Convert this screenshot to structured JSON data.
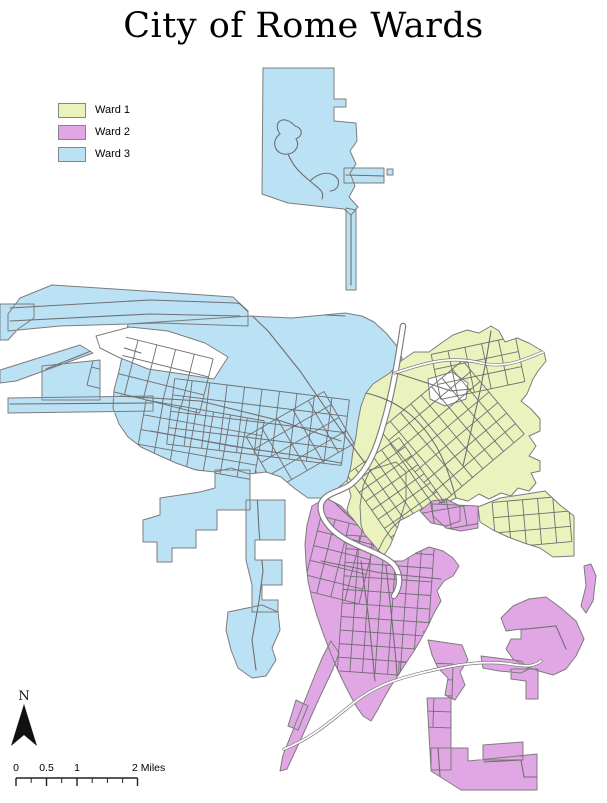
{
  "title": "City of Rome Wards",
  "legend": {
    "items": [
      {
        "label": "Ward 1",
        "color": "#EAF3BD"
      },
      {
        "label": "Ward 2",
        "color": "#E1A7E5"
      },
      {
        "label": "Ward 3",
        "color": "#BBE1F5"
      }
    ]
  },
  "north_arrow": {
    "label": "N",
    "points": "24,704 37,746 24,735 11,746",
    "label_x": 24,
    "label_y": 700,
    "color": "#111111"
  },
  "scale_bar": {
    "unit_labels": [
      "0",
      "0.5",
      "1",
      "2 Miles"
    ],
    "bar_y": 778,
    "x_start": 16,
    "x_end": 137.5,
    "major_ticks": [
      16,
      46.5,
      77,
      137.5
    ],
    "minor_ticks": [
      31.2,
      61.7,
      92.2,
      107.4,
      122.6
    ],
    "labels": [
      {
        "text": "0",
        "x": 16,
        "anchor": "middle"
      },
      {
        "text": "0.5",
        "x": 46.5,
        "anchor": "middle"
      },
      {
        "text": "1",
        "x": 77,
        "anchor": "middle"
      },
      {
        "text": "2 Miles",
        "x": 132,
        "anchor": "start"
      }
    ],
    "color": "#222222"
  },
  "map": {
    "background": "#FFFFFF",
    "boundary_color": "#7C7C7C",
    "road_color": "#6F6F6F",
    "river_casing": "#7D7D7D",
    "wards": [
      {
        "id": "w3",
        "name": "Ward 3",
        "color": "#BBE1F5",
        "path": "M263,68 L334,68 L334,99 L346,99 L346,107 L334,107 L334,121 L356,123 L357,141 L350,151 L356,164 L350,173 L355,186 L349,197 L358,207 L351,215 L344,209 L316,206 L288,203 L262,194 Z M344,168 L384,168 L384,183 L344,183 Z M387,169 L393,169 L393,175 L387,175 Z M346,208 L356,210 L356,290 L346,290 Z M8,314 L20,298 L52,285 L160,292 L233,297 L248,311 L248,326 L160,323 L60,326 L8,331 Z M0,304 L34,304 L34,318 L18,329 L8,340 L0,340 Z M0,370 L80,345 L93,353 L16,381 L0,383 Z M8,398 L153,396 L153,411 L8,413 Z M42,366 L100,360 L100,400 L42,400 Z M128,324 L250,316 L292,318 L345,313 L362,316 L374,322 L386,333 L396,345 L402,358 L401,375 L394,398 L385,420 L375,444 L363,464 L351,477 L338,488 L330,498 L308,498 L294,488 L281,477 L266,472 L249,474 L231,468 L215,472 L196,470 L176,463 L158,455 L141,447 L128,437 L119,424 L113,408 L114,390 L119,371 L124,348 Z M215,470 L250,470 L250,510 L217,510 L217,530 L196,530 L196,548 L172,548 L172,562 L157,562 L157,542 L143,542 L143,520 L160,515 L160,498 L180,495 L200,492 L215,488 Z M246,500 L285,500 L285,540 L255,540 L255,560 L282,560 L282,585 L262,585 L262,600 L278,600 L278,612 L252,612 L252,585 L246,560 Z M228,612 L262,605 L278,612 L280,630 L272,648 L276,660 L266,676 L252,678 L238,668 L231,650 L226,630 Z"
      },
      {
        "id": "w1",
        "name": "Ward 1",
        "color": "#EAF3BD",
        "path": "M390,373 L401,361 L414,352 L429,352 L440,344 L453,335 L467,330 L479,333 L491,326 L499,331 L505,342 L517,338 L529,343 L544,352 L546,361 L538,371 L533,379 L527,394 L521,401 L531,409 L540,419 L540,431 L529,436 L536,446 L529,456 L540,461 L540,471 L531,473 L536,483 L529,491 L518,488 L511,496 L501,493 L489,499 L479,494 L468,501 L456,498 L444,504 L433,504 L421,509 L409,516 L399,521 L391,529 L384,539 L379,549 L373,554 L364,546 L357,536 L351,523 L347,509 L351,496 L347,481 L351,466 L353,451 L356,436 L358,421 L361,406 L366,393 L373,384 L382,378 Z M478,507 L500,498 L520,495 L545,491 L560,505 L574,516 L574,556 L553,557 L540,548 L524,543 L508,537 L493,530 L480,522 Z M370,470 L396,462 L406,472 L406,500 L398,526 L390,546 L382,558 L373,552 L366,540 L361,525 L360,506 L363,486 Z"
      },
      {
        "id": "w2",
        "name": "Ward 2",
        "color": "#E1A7E5",
        "path": "M312,506 L326,498 L341,506 L353,519 L366,536 L379,551 L391,561 L403,561 L416,553 L429,547 L443,551 L453,558 L459,566 L453,576 L444,581 L437,591 L441,601 L434,613 L428,626 L421,639 L414,651 L406,663 L399,674 L391,686 L384,698 L377,711 L371,721 L363,716 L356,706 L349,693 L342,679 L335,664 L329,649 L323,633 L317,616 L312,599 L308,581 L306,563 L305,544 L307,525 Z M432,504 L478,506 L478,528 L461,531 L446,528 L433,516 Z M420,511 L432,501 L446,499 L460,506 L460,521 L446,526 L431,523 Z M331,641 L339,653 L333,669 L325,686 L317,703 L309,721 L301,739 L293,756 L287,769 L280,771 L283,755 L291,735 L299,715 L307,695 L315,675 L323,656 Z M296,700 L308,706 L298,730 L288,726 Z M501,618 L513,606 L529,599 L546,597 L561,608 L576,621 L584,639 L576,656 L566,669 L553,675 L539,671 L525,666 L513,659 L506,649 L511,639 L521,639 L521,629 L506,631 Z M584,566 L591,564 L596,576 L593,601 L586,613 L581,606 L586,586 Z M481,656 L521,661 L529,669 L521,673 L499,671 L483,668 Z M511,669 L538,669 L538,699 L526,699 L526,681 L511,679 Z M427,698 L451,698 L451,770 L431,770 Z M431,748 L468,748 L468,761 L537,754 L537,790 L461,790 L431,771 Z M483,745 L523,742 L523,760 L483,760 Z M428,640 L462,645 L468,660 L460,672 L465,685 L455,700 L445,695 L448,678 L438,668 L432,655 Z"
      }
    ],
    "holes": [
      {
        "path": "M96,336 L130,327 L168,331 L205,343 L228,357 L214,379 L182,374 L148,369 L118,357 L100,348 Z"
      },
      {
        "path": "M428,379 L452,372 L468,383 L466,399 L445,406 L430,399 Z"
      }
    ],
    "river": {
      "path": "M403,326 C397,366 391,400 381,432 C373,459 363,475 350,485 C337,493 325,493 321,504 C319,515 328,529 345,539 C362,549 381,553 393,564 C401,573 401,586 394,596"
    },
    "roads": [
      {
        "d": "M10,308 L150,300 L236,303 L290,313 L345,316",
        "clip": "w3"
      },
      {
        "d": "M10,321 L150,314 L240,316",
        "clip": "w3"
      },
      {
        "d": "M240,304 L268,331 L300,371 L331,416 L356,451 L371,471",
        "clip": "w3"
      },
      {
        "d": "M10,404 L152,403",
        "clip": "w3"
      },
      {
        "d": "M46,369 L91,351",
        "clip": "w3"
      },
      {
        "d": "M120,396 L200,401 L281,421 L341,441",
        "clip": "w3"
      },
      {
        "d": "M151,431 L231,446 L301,456 L341,463",
        "clip": "w3"
      },
      {
        "d": "M256,471 L259,531 L263,571 L259,601 L252,640 L256,670",
        "clip": "w3"
      },
      {
        "d": "M395,373 C430,361 452,356 481,363 C506,369 526,359 545,351",
        "clip": "w1",
        "casing": true
      },
      {
        "d": "M366,393 C401,401 421,421 436,446 C446,463 451,481 456,498",
        "clip": "w1"
      },
      {
        "d": "M491,331 L486,361 L479,396 L471,431 L463,466",
        "clip": "w1"
      },
      {
        "d": "M396,373 L421,381 L451,391 L471,389",
        "clip": "w1"
      },
      {
        "d": "M386,566 L391,611 L396,661 L399,701 L401,741",
        "clip": "w2"
      },
      {
        "d": "M361,561 L369,621 L375,681",
        "clip": "w2"
      },
      {
        "d": "M321,561 L381,573 L441,579",
        "clip": "w2"
      },
      {
        "d": "M284,749 C311,739 331,721 356,701 C376,686 396,679 421,673 C446,667 471,661 501,663 C521,665 531,669 541,661",
        "casing": true
      },
      {
        "d": "M295,126 C283,113 272,123 280,134 C270,141 275,156 288,154 C296,153 300,145 296,139 C304,135 302,128 295,126",
        "clip": "w3"
      },
      {
        "d": "M288,154 C293,166 300,173 310,181 C318,188 325,191 322,199",
        "clip": "w3"
      },
      {
        "d": "M310,181 C318,173 328,171 335,176 C342,181 338,191 330,191",
        "clip": "w3"
      },
      {
        "d": "M351,215 L351,285",
        "clip": "w3"
      },
      {
        "d": "M346,175 L384,176"
      },
      {
        "d": "M60,331 L101,341 L141,353",
        "clip": "w3"
      },
      {
        "d": "M331,499 C341,509 351,519 361,526",
        "clip": "w2"
      },
      {
        "d": "M423,632 L448,628 L441,601",
        "clip": "w2"
      },
      {
        "d": "M506,631 L556,626 L566,649",
        "clip": "w2"
      },
      {
        "d": "M438,748 L441,790",
        "clip": "w2"
      },
      {
        "d": "M484,762 L521,760 L524,777 L537,777",
        "clip": "w2"
      }
    ],
    "grids": [
      {
        "cx": 398,
        "cy": 492,
        "w": 64,
        "h": 88,
        "angle": -35,
        "nx": 7,
        "ny": 9,
        "clip": "w1"
      },
      {
        "cx": 452,
        "cy": 432,
        "w": 108,
        "h": 96,
        "angle": -40,
        "nx": 9,
        "ny": 8,
        "clip": "w1"
      },
      {
        "cx": 478,
        "cy": 368,
        "w": 86,
        "h": 46,
        "angle": -12,
        "nx": 6,
        "ny": 4,
        "clip": "w1"
      },
      {
        "cx": 532,
        "cy": 522,
        "w": 76,
        "h": 46,
        "angle": -5,
        "nx": 6,
        "ny": 4,
        "clip": "w1"
      },
      {
        "cx": 386,
        "cy": 606,
        "w": 88,
        "h": 136,
        "angle": 4,
        "nx": 8,
        "ny": 11,
        "clip": "w2"
      },
      {
        "cx": 340,
        "cy": 560,
        "w": 58,
        "h": 76,
        "angle": 14,
        "nx": 5,
        "ny": 6,
        "clip": "w2"
      },
      {
        "cx": 425,
        "cy": 695,
        "w": 54,
        "h": 64,
        "angle": 2,
        "nx": 4,
        "ny": 5,
        "clip": "w2"
      },
      {
        "cx": 440,
        "cy": 510,
        "w": 80,
        "h": 40,
        "angle": -10,
        "nx": 6,
        "ny": 3,
        "clip": "w2"
      },
      {
        "cx": 258,
        "cy": 422,
        "w": 176,
        "h": 66,
        "angle": 7,
        "nx": 11,
        "ny": 5,
        "clip": "w3"
      },
      {
        "cx": 150,
        "cy": 372,
        "w": 116,
        "h": 56,
        "angle": 14,
        "nx": 7,
        "ny": 4,
        "clip": "w3"
      },
      {
        "cx": 200,
        "cy": 440,
        "w": 120,
        "h": 60,
        "angle": 10,
        "nx": 8,
        "ny": 5,
        "clip": "w3"
      },
      {
        "cx": 300,
        "cy": 440,
        "w": 90,
        "h": 60,
        "angle": -30,
        "nx": 6,
        "ny": 5,
        "clip": "w3"
      }
    ]
  }
}
